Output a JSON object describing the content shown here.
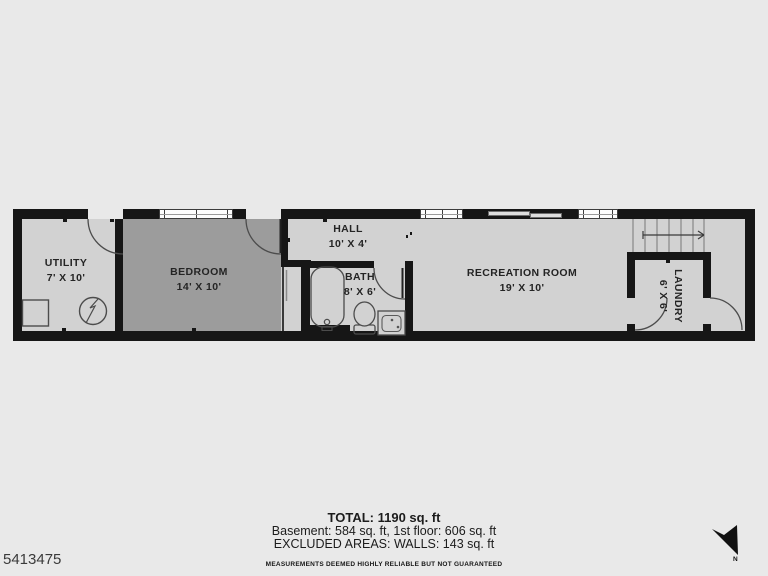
{
  "page": {
    "id_number": "5413475"
  },
  "floor_plan": {
    "rooms": [
      {
        "name": "UTILITY",
        "dims": "7' X 10'"
      },
      {
        "name": "BEDROOM",
        "dims": "14' X 10'"
      },
      {
        "name": "HALL",
        "dims": "10' X 4'"
      },
      {
        "name": "BATH",
        "dims": "8' X 6'"
      },
      {
        "name": "RECREATION ROOM",
        "dims": "19' X 10'"
      },
      {
        "name": "LAUNDRY",
        "dims": "6' X 6'"
      }
    ],
    "compass": {
      "label": "N"
    }
  },
  "summary": {
    "total": "TOTAL: 1190 sq. ft",
    "breakdown": "Basement: 584 sq. ft, 1st floor: 606 sq. ft",
    "excluded": "EXCLUDED AREAS: WALLS: 143 sq. ft",
    "disclaimer": "MEASUREMENTS DEEMED HIGHLY RELIABLE BUT NOT GUARANTEED"
  },
  "colors": {
    "background": "#e9e9e9",
    "room_fill": "#d2d2d2",
    "bedroom_fill": "#9c9c9c",
    "wall": "#161616",
    "text": "#242424"
  }
}
